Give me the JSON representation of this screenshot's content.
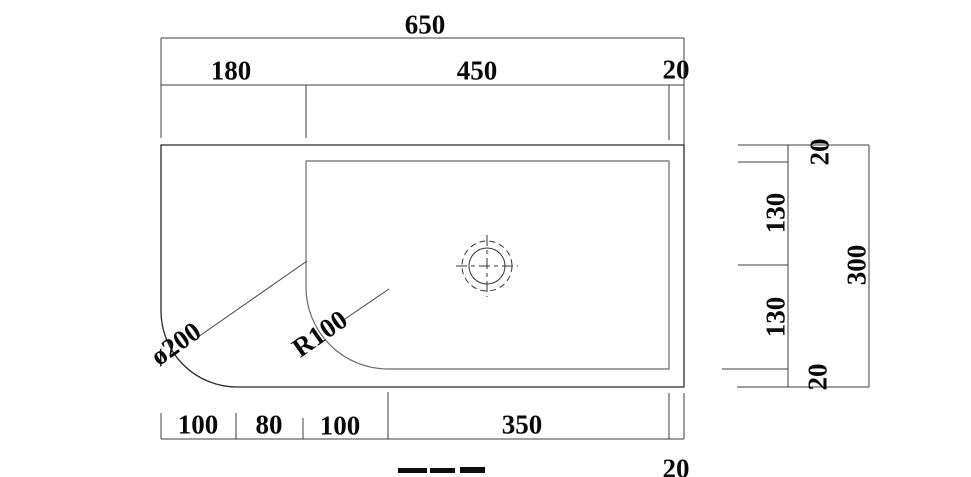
{
  "dims": {
    "top": {
      "overall": "650",
      "seg1": "180",
      "seg2": "450",
      "seg3": "20"
    },
    "bottom": {
      "seg1": "100",
      "seg2": "80",
      "seg3": "100",
      "seg4": "350",
      "seg5": "20"
    },
    "side": {
      "overall": "300",
      "seg1": "20",
      "seg2": "130",
      "seg3": "130",
      "seg4": "20"
    },
    "annotations": {
      "outer_corner": "ø200",
      "inner_corner": "R100"
    }
  },
  "colors": {
    "outer_outline": "#2b2b2b",
    "inner_outline": "#6a6a6a",
    "dimension_lines": "#3f3f3f",
    "text": "#0a0a0a",
    "background": "#ffffff"
  }
}
